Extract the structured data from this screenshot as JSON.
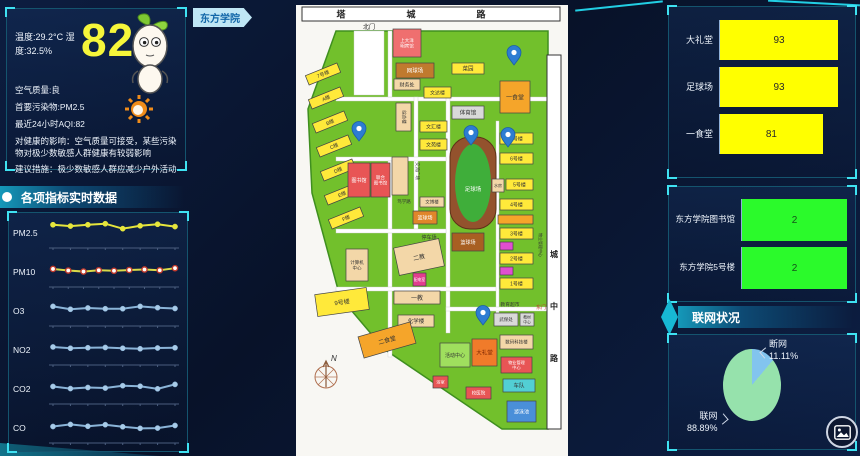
{
  "weather_panel": {
    "temp_humidity": "温度:29.2°C 湿度:32.5%",
    "aqi_value": "82",
    "quality": "空气质量:良",
    "pollutant": "首要污染物:PM2.5",
    "aqi_24h": "最近24小时AQI:82",
    "impact": "对健康的影响：空气质量可接受，某些污染物对极少数敏感人群健康有较弱影响",
    "advice": "建议措施：极少数敏感人群应减少户外活动"
  },
  "indicators_title": "各项指标实时数据",
  "campus_tag": "东方学院",
  "network_title": "联网状况",
  "icons": {
    "mascot": "sprout-mascot-icon",
    "sun": "sun-icon",
    "image_button": "image-icon"
  },
  "chart_data": [
    {
      "id": "indicators",
      "type": "line",
      "title": "各项指标实时数据",
      "axis_color": "#4a5d7e",
      "ylim": [
        0,
        10
      ],
      "series": [
        {
          "name": "PM2.5",
          "color": "#e6e63c",
          "dot": "#e6e63c",
          "values": [
            7.4,
            6.9,
            7.4,
            7.8,
            5.9,
            7.0,
            7.6,
            6.7
          ]
        },
        {
          "name": "PM10",
          "color": "#d9d948",
          "dot": "#ffffff",
          "dot_ring": "#c0392b",
          "values": [
            5.4,
            4.8,
            4.4,
            4.9,
            4.7,
            5.0,
            5.2,
            4.9,
            5.7
          ]
        },
        {
          "name": "O3",
          "color": "#8ab4d8",
          "dot": "#a8cbe8",
          "values": [
            6.0,
            4.9,
            5.4,
            5.1,
            5.1,
            6.0,
            5.5,
            5.2
          ]
        },
        {
          "name": "NO2",
          "color": "#8ab4d8",
          "dot": "#a8cbe8",
          "values": [
            5.4,
            4.9,
            5.1,
            5.2,
            4.9,
            4.7,
            5.0,
            5.1
          ]
        },
        {
          "name": "CO2",
          "color": "#8ab4d8",
          "dot": "#a8cbe8",
          "values": [
            5.2,
            4.4,
            4.8,
            4.6,
            5.5,
            5.3,
            4.3,
            6.0
          ]
        },
        {
          "name": "CO",
          "color": "#8ab4d8",
          "dot": "#a8cbe8",
          "values": [
            4.8,
            5.6,
            4.9,
            5.5,
            4.7,
            4.1,
            4.2,
            5.2
          ]
        }
      ]
    },
    {
      "id": "usage",
      "type": "bar",
      "orientation": "horizontal",
      "categories": [
        "大礼堂",
        "足球场",
        "一食堂"
      ],
      "values": [
        93,
        93,
        81
      ],
      "max": 100,
      "bar_color": "#ffff00",
      "value_color": "#2a2a2a"
    },
    {
      "id": "devices",
      "type": "bar",
      "orientation": "horizontal",
      "categories": [
        "东方学院图书馆",
        "东方学院5号楼"
      ],
      "values": [
        2,
        2
      ],
      "max": 2,
      "bar_color": "#2bfa2b",
      "value_color": "#14521a"
    },
    {
      "id": "network",
      "type": "pie",
      "title": "联网状况",
      "slices": [
        {
          "label": "断网",
          "value": 11.11,
          "pct": "11.11%",
          "color": "#82c4ee"
        },
        {
          "label": "联网",
          "value": 88.89,
          "pct": "88.89%",
          "color": "#96e2ac"
        }
      ]
    }
  ],
  "map": {
    "page_color": "#f8f7f3",
    "campus_color": "#72c02c",
    "campus_stroke": "#3f8f1f",
    "campus_path": "M40,26 L252,26 L252,424 L206,424 L88,344 L44,292 L16,188 L12,104 Z",
    "road_color": "#ffffff",
    "top_road": {
      "rect": [
        6,
        2,
        258,
        14
      ],
      "label": "塔城路"
    },
    "right_road": {
      "rect": [
        251,
        50,
        14,
        374
      ],
      "label": "城中路"
    },
    "inner_roads": [
      [
        58,
        26,
        30,
        64
      ],
      [
        40,
        92,
        212,
        4
      ],
      [
        92,
        26,
        4,
        66
      ],
      [
        118,
        92,
        4,
        132
      ],
      [
        150,
        92,
        4,
        236
      ],
      [
        40,
        152,
        110,
        4
      ],
      [
        92,
        156,
        4,
        196
      ],
      [
        40,
        224,
        110,
        4
      ],
      [
        40,
        282,
        162,
        4
      ],
      [
        200,
        116,
        3,
        192
      ],
      [
        150,
        302,
        102,
        4
      ]
    ],
    "buildings": [
      {
        "x": 97,
        "y": 24,
        "w": 28,
        "h": 28,
        "c": "#ef6f6f",
        "l": "上大洋|明宾馆",
        "tc": "#ffffff",
        "fs": 4.5
      },
      {
        "x": 100,
        "y": 58,
        "w": 38,
        "h": 15,
        "c": "#c07a2e",
        "l": "网球场",
        "tc": "#ffffff",
        "fs": 5.5
      },
      {
        "x": 156,
        "y": 58,
        "w": 32,
        "h": 11,
        "c": "#ffe93a",
        "l": "菜园",
        "tc": "#333333",
        "fs": 5.5
      },
      {
        "x": 204,
        "y": 76,
        "w": 30,
        "h": 32,
        "c": "#f5a52a",
        "l": "一食堂",
        "tc": "#333333",
        "fs": 6
      },
      {
        "x": 156,
        "y": 101,
        "w": 32,
        "h": 13,
        "c": "#d9d9d9",
        "l": "体育馆",
        "tc": "#333333",
        "fs": 5.5
      },
      {
        "x": 98,
        "y": 74,
        "w": 26,
        "h": 11,
        "c": "#f3d7a8",
        "l": "财务处",
        "tc": "#333333",
        "fs": 5
      },
      {
        "x": 100,
        "y": 98,
        "w": 15,
        "h": 28,
        "c": "#f3d7a8",
        "l": "综合楼",
        "tc": "#333333",
        "fs": 4.5,
        "vert": true
      },
      {
        "x": 128,
        "y": 82,
        "w": 27,
        "h": 11,
        "c": "#ffe93a",
        "l": "文达楼",
        "tc": "#333333",
        "fs": 5
      },
      {
        "x": 124,
        "y": 116,
        "w": 27,
        "h": 11,
        "c": "#ffe93a",
        "l": "文汇楼",
        "tc": "#333333",
        "fs": 5
      },
      {
        "x": 124,
        "y": 134,
        "w": 27,
        "h": 11,
        "c": "#ffe93a",
        "l": "文苑楼",
        "tc": "#333333",
        "fs": 5
      },
      {
        "x": 10,
        "y": 64,
        "w": 34,
        "h": 10,
        "c": "#ffe93a",
        "l": "7号楼",
        "tc": "#333333",
        "fs": 5,
        "rot": -22
      },
      {
        "x": 13,
        "y": 88,
        "w": 34,
        "h": 10,
        "c": "#ffe93a",
        "l": "A楼",
        "tc": "#333333",
        "fs": 5,
        "rot": -22
      },
      {
        "x": 17,
        "y": 112,
        "w": 34,
        "h": 10,
        "c": "#ffe93a",
        "l": "B楼",
        "tc": "#333333",
        "fs": 5,
        "rot": -22
      },
      {
        "x": 21,
        "y": 136,
        "w": 34,
        "h": 10,
        "c": "#ffe93a",
        "l": "C楼",
        "tc": "#333333",
        "fs": 5,
        "rot": -22
      },
      {
        "x": 25,
        "y": 160,
        "w": 34,
        "h": 10,
        "c": "#ffe93a",
        "l": "D楼",
        "tc": "#333333",
        "fs": 5,
        "rot": -22
      },
      {
        "x": 29,
        "y": 184,
        "w": 34,
        "h": 10,
        "c": "#ffe93a",
        "l": "E楼",
        "tc": "#333333",
        "fs": 5,
        "rot": -22
      },
      {
        "x": 33,
        "y": 208,
        "w": 34,
        "h": 10,
        "c": "#ffe93a",
        "l": "F楼",
        "tc": "#333333",
        "fs": 5,
        "rot": -22
      },
      {
        "x": 52,
        "y": 158,
        "w": 22,
        "h": 34,
        "c": "#e85555",
        "l": "图书馆",
        "tc": "#ffffff",
        "fs": 5
      },
      {
        "x": 75,
        "y": 158,
        "w": 19,
        "h": 34,
        "c": "#e85555",
        "l": "联合|图书馆",
        "tc": "#ffffff",
        "fs": 4.5
      },
      {
        "x": 96,
        "y": 152,
        "w": 16,
        "h": 38,
        "c": "#f3d7a8",
        "l": "",
        "tc": "#333333",
        "fs": 5
      },
      {
        "x": 124,
        "y": 192,
        "w": 24,
        "h": 10,
        "c": "#f3d7a8",
        "l": "文博楼",
        "tc": "#333333",
        "fs": 4.5
      },
      {
        "x": 117,
        "y": 206,
        "w": 24,
        "h": 13,
        "c": "#e0862a",
        "l": "篮球场",
        "tc": "#ffffff",
        "fs": 5
      },
      {
        "x": 154,
        "y": 132,
        "w": 46,
        "h": 92,
        "type": "field",
        "l": "足球场"
      },
      {
        "x": 156,
        "y": 228,
        "w": 32,
        "h": 18,
        "c": "#a85f22",
        "l": "篮球场",
        "tc": "#ffffff",
        "fs": 5
      },
      {
        "x": 100,
        "y": 238,
        "w": 46,
        "h": 28,
        "c": "#f3d7a8",
        "l": "二教",
        "tc": "#333333",
        "fs": 6,
        "rot": -12
      },
      {
        "x": 117,
        "y": 268,
        "w": 13,
        "h": 13,
        "c": "#e23d8e",
        "l": "配电室",
        "tc": "#ffffff",
        "fs": 3.8
      },
      {
        "x": 98,
        "y": 286,
        "w": 46,
        "h": 13,
        "c": "#f3d7a8",
        "l": "一教",
        "tc": "#333333",
        "fs": 6
      },
      {
        "x": 102,
        "y": 310,
        "w": 36,
        "h": 12,
        "c": "#f3d7a8",
        "l": "化学楼",
        "tc": "#333333",
        "fs": 5.5
      },
      {
        "x": 50,
        "y": 244,
        "w": 22,
        "h": 32,
        "c": "#f3d7a8",
        "l": "计算机|中心",
        "tc": "#333333",
        "fs": 4.5
      },
      {
        "x": 20,
        "y": 286,
        "w": 52,
        "h": 22,
        "c": "#ffe93a",
        "l": "9号楼",
        "tc": "#333333",
        "fs": 6,
        "rot": -8
      },
      {
        "x": 64,
        "y": 324,
        "w": 54,
        "h": 22,
        "c": "#f5a52a",
        "l": "二食堂",
        "tc": "#333333",
        "fs": 6,
        "rot": -16
      },
      {
        "x": 144,
        "y": 338,
        "w": 30,
        "h": 24,
        "c": "#9fdf5e",
        "l": "活动中心",
        "tc": "#333333",
        "fs": 5
      },
      {
        "x": 176,
        "y": 334,
        "w": 25,
        "h": 27,
        "c": "#f07b2a",
        "l": "大礼堂",
        "tc": "#7a2400",
        "fs": 5.5
      },
      {
        "x": 204,
        "y": 330,
        "w": 33,
        "h": 14,
        "c": "#f3d7a8",
        "l": "数码科技楼",
        "tc": "#333333",
        "fs": 4.5
      },
      {
        "x": 205,
        "y": 352,
        "w": 31,
        "h": 16,
        "c": "#e85555",
        "l": "物业管理|中心",
        "tc": "#ffffff",
        "fs": 4.2
      },
      {
        "x": 207,
        "y": 374,
        "w": 32,
        "h": 13,
        "c": "#52cfd4",
        "l": "车队",
        "tc": "#333333",
        "fs": 5.5
      },
      {
        "x": 170,
        "y": 382,
        "w": 25,
        "h": 12,
        "c": "#e85555",
        "l": "校医院",
        "tc": "#ffffff",
        "fs": 4.5
      },
      {
        "x": 211,
        "y": 396,
        "w": 29,
        "h": 21,
        "c": "#4a8fd9",
        "l": "游泳池",
        "tc": "#ffffff",
        "fs": 5
      },
      {
        "x": 137,
        "y": 371,
        "w": 15,
        "h": 12,
        "c": "#e85555",
        "l": "浴室",
        "tc": "#ffffff",
        "fs": 4.2
      },
      {
        "x": 204,
        "y": 128,
        "w": 33,
        "h": 11,
        "c": "#ffe93a",
        "l": "7号楼",
        "tc": "#333333",
        "fs": 5
      },
      {
        "x": 204,
        "y": 148,
        "w": 33,
        "h": 11,
        "c": "#ffe93a",
        "l": "6号楼",
        "tc": "#333333",
        "fs": 5
      },
      {
        "x": 196,
        "y": 174,
        "w": 12,
        "h": 13,
        "c": "#f3d7a8",
        "l": "水房",
        "tc": "#333333",
        "fs": 4
      },
      {
        "x": 210,
        "y": 174,
        "w": 27,
        "h": 11,
        "c": "#ffe93a",
        "l": "5号楼",
        "tc": "#333333",
        "fs": 5
      },
      {
        "x": 204,
        "y": 194,
        "w": 33,
        "h": 11,
        "c": "#ffe93a",
        "l": "4号楼",
        "tc": "#333333",
        "fs": 5
      },
      {
        "x": 202,
        "y": 210,
        "w": 35,
        "h": 9,
        "c": "#f5a52a",
        "l": "",
        "tc": "#333333",
        "fs": 4
      },
      {
        "x": 204,
        "y": 223,
        "w": 33,
        "h": 11,
        "c": "#ffe93a",
        "l": "3号楼",
        "tc": "#333333",
        "fs": 5
      },
      {
        "x": 204,
        "y": 237,
        "w": 13,
        "h": 8,
        "c": "#e04fd0",
        "l": "",
        "tc": "#333333",
        "fs": 4
      },
      {
        "x": 204,
        "y": 248,
        "w": 33,
        "h": 11,
        "c": "#ffe93a",
        "l": "2号楼",
        "tc": "#333333",
        "fs": 5
      },
      {
        "x": 204,
        "y": 262,
        "w": 13,
        "h": 8,
        "c": "#e04fd0",
        "l": "",
        "tc": "#333333",
        "fs": 4
      },
      {
        "x": 204,
        "y": 273,
        "w": 33,
        "h": 11,
        "c": "#ffe93a",
        "l": "1号楼",
        "tc": "#333333",
        "fs": 5
      },
      {
        "x": 198,
        "y": 308,
        "w": 24,
        "h": 13,
        "c": "#d9d9d9",
        "l": "武保处",
        "tc": "#333333",
        "fs": 4.5
      },
      {
        "x": 224,
        "y": 308,
        "w": 14,
        "h": 13,
        "c": "#d9d9d9",
        "l": "教材|中心",
        "tc": "#333333",
        "fs": 3.8
      }
    ],
    "texts": [
      {
        "t": "北门",
        "x": 73,
        "y": 24,
        "c": "#222222",
        "fs": 6
      },
      {
        "t": "停车场",
        "x": 133,
        "y": 234,
        "c": "#333333",
        "fs": 5
      },
      {
        "t": "交流广场",
        "x": 120,
        "y": 166,
        "c": "#333333",
        "fs": 4.5,
        "vert": true
      },
      {
        "t": "笃学路",
        "x": 108,
        "y": 198,
        "c": "#333333",
        "fs": 4.5
      },
      {
        "t": "教育超市",
        "x": 214,
        "y": 301,
        "c": "#333333",
        "fs": 4.8
      },
      {
        "t": "东门",
        "x": 245,
        "y": 304,
        "c": "#c0392b",
        "fs": 5
      },
      {
        "t": "物业管理中心",
        "x": 243,
        "y": 240,
        "c": "#333333",
        "fs": 4,
        "vert": true
      }
    ],
    "pins": [
      [
        218,
        60
      ],
      [
        63,
        136
      ],
      [
        175,
        140
      ],
      [
        212,
        142
      ],
      [
        187,
        320
      ]
    ],
    "pin_color": "#2d7dd2",
    "compass": {
      "x": 30,
      "y": 372,
      "label": "N"
    }
  }
}
